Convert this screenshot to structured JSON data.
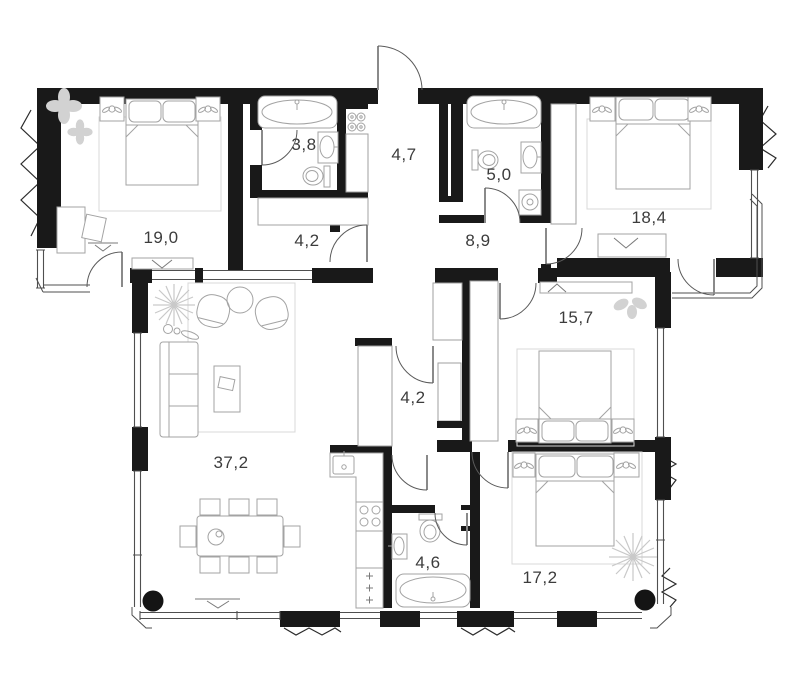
{
  "colors": {
    "wall": "#191919",
    "door_arc": "#5a5a5a",
    "furniture": "#a3a3a3",
    "carpet": "#d8d8d8",
    "decor": "#cccccc",
    "label": "#3c3c3c",
    "background": "#ffffff"
  },
  "rooms": [
    {
      "name": "bedroom-top-left",
      "area": "19,0"
    },
    {
      "name": "bathroom-top-left",
      "area": "3,8"
    },
    {
      "name": "closet-top",
      "area": "4,2"
    },
    {
      "name": "entry-hall",
      "area": "4,7"
    },
    {
      "name": "bathroom-top-right",
      "area": "5,0"
    },
    {
      "name": "corridor",
      "area": "8,9"
    },
    {
      "name": "bedroom-top-right",
      "area": "18,4"
    },
    {
      "name": "bedroom-middle-right",
      "area": "15,7"
    },
    {
      "name": "hall-middle",
      "area": "4,2"
    },
    {
      "name": "living-kitchen",
      "area": "37,2"
    },
    {
      "name": "bathroom-bottom",
      "area": "4,6"
    },
    {
      "name": "bedroom-bottom-right",
      "area": "17,2"
    }
  ]
}
